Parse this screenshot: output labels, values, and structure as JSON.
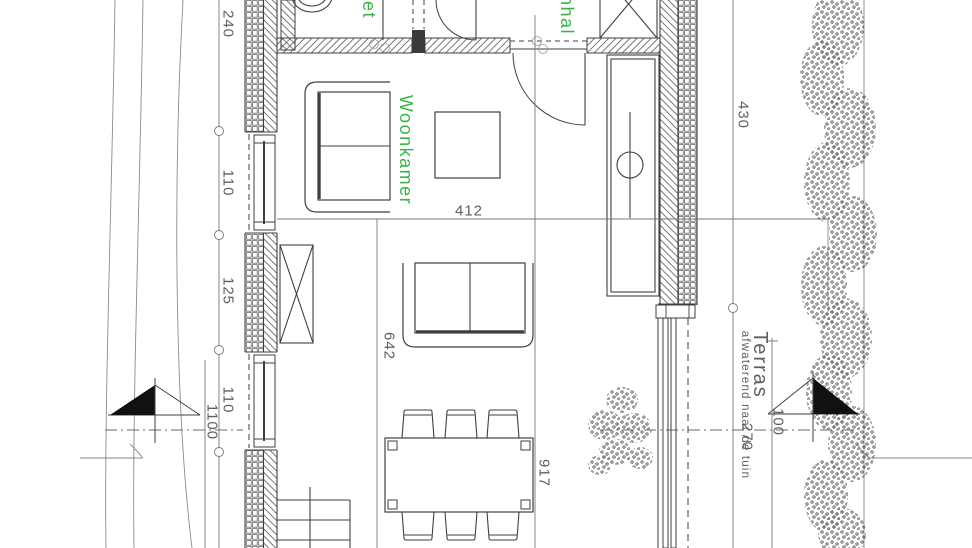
{
  "drawing": {
    "type": "architectural-floor-plan",
    "colors": {
      "accent_green": "#3cb24c",
      "line": "#3f3f3f",
      "dimension": "#5f5f5f"
    }
  },
  "labels": {
    "woonkamer": "Woonkamer",
    "toilet_partial": "et",
    "hall_partial": "nhal",
    "terras": "Terras",
    "terras_note": "afwaterend naar de tuin"
  },
  "dims": {
    "left_top": "240",
    "left_upper_window": "110",
    "left_pier": "125",
    "left_lower_window": "110",
    "left_overall": "1100",
    "livingroom_width": "412",
    "livingroom_length": "642",
    "dining_zone": "917",
    "right_top": "430",
    "terras_depth": "270",
    "hedge_offset": "100"
  }
}
